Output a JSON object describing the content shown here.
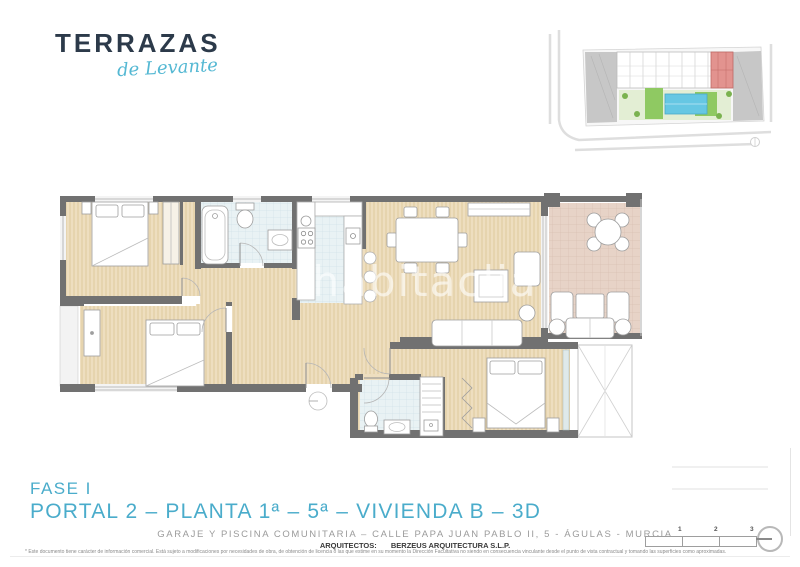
{
  "brand": {
    "name": "TERRAZAS",
    "tagline": "de Levante",
    "name_color": "#2c3a4a",
    "tagline_color": "#54b8d3"
  },
  "watermark": "habitaclia",
  "titles": {
    "phase": "FASE I",
    "unit": "PORTAL 2 – PLANTA 1ª – 5ª – VIVIENDA B – 3D",
    "color": "#4aaccb"
  },
  "address_line": "GARAJE Y PISCINA COMUNITARIA – CALLE PAPA JUAN PABLO II, 5 - ÁGULAS - MURCIA",
  "architects": {
    "label": "ARQUITECTOS:",
    "name": "BERZEUS ARQUITECTURA S.L.P."
  },
  "disclaimer": "* Este documento tiene carácter de información comercial. Está sujeto a modificaciones por necesidades de obra, de obtención de licencia o las que estime en su momento la Dirección Facultativa no siendo en consecuencia vinculante desde el punto de vista contractual y tomando las superficies como aproximadas.",
  "scale_bar": {
    "labels": [
      "1",
      "2",
      "3"
    ]
  },
  "colors": {
    "title_blue": "#4aaccb",
    "wall_gray": "#717171",
    "wood_floor": "#eedebf",
    "tile_blue": "#e9f2f4",
    "terrace_tan": "#e7d3c7",
    "site_highlight_red": "#e2938f",
    "pool_blue": "#66c7e3",
    "landscape_green": "#8fc962"
  }
}
